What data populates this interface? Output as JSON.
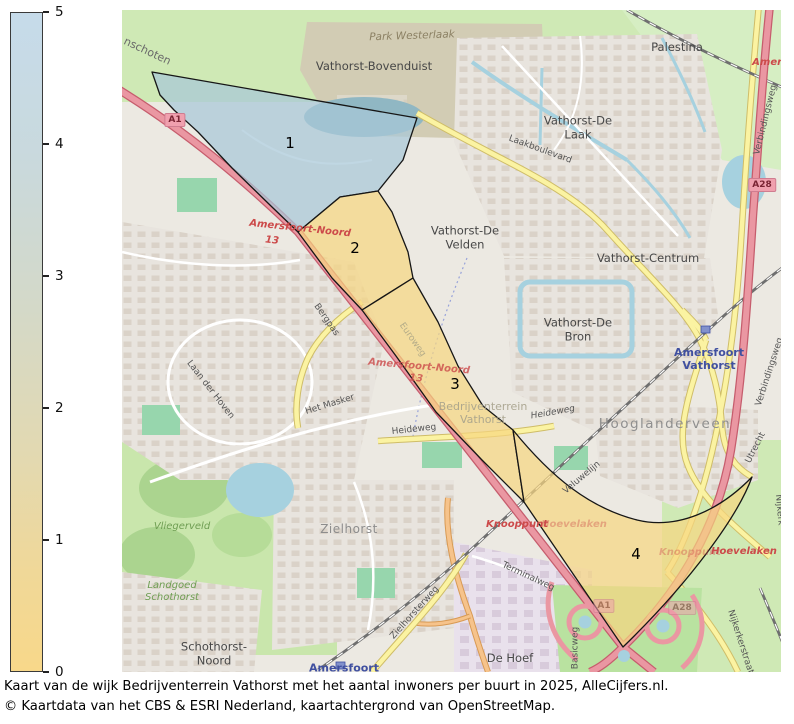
{
  "legend": {
    "max": 5,
    "min": 0,
    "ticks": [
      5,
      4,
      3,
      2,
      1,
      0
    ],
    "top_color": "#c6dbea",
    "bottom_color": "#f8d88a"
  },
  "map": {
    "regions": [
      {
        "number": "1",
        "fill": "#a8c8d8"
      },
      {
        "number": "2",
        "fill": "#f7d680"
      },
      {
        "number": "3",
        "fill": "#f7d680"
      },
      {
        "number": "4",
        "fill": "#f7d680"
      }
    ],
    "labels": [
      {
        "name": "road-label-bunschoten",
        "text": "nschoten",
        "x": 25,
        "y": 42,
        "rot": 25,
        "cls": "road road-lg"
      },
      {
        "name": "park-label-westerlaak",
        "text": "Park Westerlaak",
        "x": 290,
        "y": 26,
        "rot": -2,
        "cls": "park-label"
      },
      {
        "name": "hood-label-bovenduist",
        "text": "Vathorst-Bovenduist",
        "x": 252,
        "y": 57,
        "rot": 0,
        "cls": "hood"
      },
      {
        "name": "hood-label-palestina",
        "text": "Palestina",
        "x": 555,
        "y": 38,
        "rot": 0,
        "cls": "hood"
      },
      {
        "name": "exit-label-amersfoort-ne",
        "text": "Amersfoort",
        "x": 662,
        "y": 53,
        "rot": 0,
        "cls": "exit-red"
      },
      {
        "name": "badge-a1",
        "text": "A1",
        "x": 53,
        "y": 110,
        "rot": 0,
        "cls": "badge"
      },
      {
        "name": "hood-label-de-laak",
        "text": "Vathorst-De\nLaak",
        "x": 456,
        "y": 118,
        "rot": 0,
        "cls": "hood"
      },
      {
        "name": "road-label-laakboulevard",
        "text": "Laakboulevard",
        "x": 418,
        "y": 140,
        "rot": 20,
        "cls": "road"
      },
      {
        "name": "road-label-verbindingsweg-n",
        "text": "Verbindingsweg",
        "x": 644,
        "y": 110,
        "rot": -76,
        "cls": "road"
      },
      {
        "name": "badge-a28-n",
        "text": "A28",
        "x": 640,
        "y": 175,
        "rot": 0,
        "cls": "badge"
      },
      {
        "name": "hood-label-de-velden",
        "text": "Vathorst-De\nVelden",
        "x": 343,
        "y": 228,
        "rot": 0,
        "cls": "hood"
      },
      {
        "name": "hood-label-centrum",
        "text": "Vathorst-Centrum",
        "x": 526,
        "y": 249,
        "rot": 0,
        "cls": "hood"
      },
      {
        "name": "hood-label-de-bron",
        "text": "Vathorst-De\nBron",
        "x": 456,
        "y": 320,
        "rot": 0,
        "cls": "hood"
      },
      {
        "name": "station-label-amersfoort-vathorst",
        "text": "Amersfoort\nVathorst",
        "x": 587,
        "y": 350,
        "rot": 0,
        "cls": "station"
      },
      {
        "name": "road-label-verbindingsweg-s",
        "text": "Verbindingsweg",
        "x": 648,
        "y": 362,
        "rot": -72,
        "cls": "road"
      },
      {
        "name": "hood-label-hooglanderveen",
        "text": "Hooglanderveen",
        "x": 543,
        "y": 415,
        "rot": 0,
        "cls": "hood-lg"
      },
      {
        "name": "road-label-heideweg-w",
        "text": "Heideweg",
        "x": 292,
        "y": 420,
        "rot": -6,
        "cls": "road"
      },
      {
        "name": "road-label-heideweg-e",
        "text": "Heideweg",
        "x": 431,
        "y": 403,
        "rot": -10,
        "cls": "road road-it"
      },
      {
        "name": "road-label-het-masker",
        "text": "Het Masker",
        "x": 208,
        "y": 395,
        "rot": -17,
        "cls": "road"
      },
      {
        "name": "road-label-laan-der-hoven",
        "text": "Laan der Hoven",
        "x": 88,
        "y": 380,
        "rot": 52,
        "cls": "road"
      },
      {
        "name": "road-label-bergpas",
        "text": "Bergpas",
        "x": 204,
        "y": 310,
        "rot": 55,
        "cls": "road"
      },
      {
        "name": "road-label-euroweg",
        "text": "Euroweg",
        "x": 290,
        "y": 330,
        "rot": 55,
        "cls": "road-faint"
      },
      {
        "name": "exit-label-amersfoort-noord-1",
        "text": "Amersfoort-Noord",
        "x": 178,
        "y": 219,
        "rot": 6,
        "cls": "exit-red"
      },
      {
        "name": "exit-label-13-1",
        "text": "13",
        "x": 150,
        "y": 231,
        "rot": 6,
        "cls": "exit-red"
      },
      {
        "name": "exit-label-amersfoort-noord-2",
        "text": "Amersfoort-Noord",
        "x": 297,
        "y": 357,
        "rot": 5,
        "cls": "exit-red exit-faint2"
      },
      {
        "name": "exit-label-13-2",
        "text": "13",
        "x": 294,
        "y": 369,
        "rot": 5,
        "cls": "exit-red exit-faint2"
      },
      {
        "name": "hood-label-bedrijventerrein",
        "text": "Bedrijventerrein\nVathorst",
        "x": 361,
        "y": 404,
        "rot": 0,
        "cls": "hood-faint"
      },
      {
        "name": "region-label-1",
        "text": "1",
        "x": 168,
        "y": 134,
        "rot": 0,
        "cls": "region-num"
      },
      {
        "name": "region-label-2",
        "text": "2",
        "x": 233,
        "y": 239,
        "rot": 0,
        "cls": "region-num"
      },
      {
        "name": "region-label-3",
        "text": "3",
        "x": 333,
        "y": 375,
        "rot": 0,
        "cls": "region-num"
      },
      {
        "name": "region-label-4",
        "text": "4",
        "x": 514,
        "y": 545,
        "rot": 0,
        "cls": "region-num"
      },
      {
        "name": "exit-label-knooppunt-w",
        "text": "Knooppunt",
        "x": 395,
        "y": 515,
        "rot": 0,
        "cls": "exit-red"
      },
      {
        "name": "exit-label-hoevelaken-w",
        "text": "Hoevelaken",
        "x": 452,
        "y": 515,
        "rot": 0,
        "cls": "exit-red exit-faint"
      },
      {
        "name": "exit-label-knooppunt-e",
        "text": "Knooppunt",
        "x": 568,
        "y": 543,
        "rot": 0,
        "cls": "exit-red exit-faint"
      },
      {
        "name": "exit-label-hoevelaken-e",
        "text": "Hoevelaken",
        "x": 622,
        "y": 542,
        "rot": 0,
        "cls": "exit-red"
      },
      {
        "name": "road-label-terminalweg",
        "text": "Terminalweg",
        "x": 406,
        "y": 567,
        "rot": 25,
        "cls": "road"
      },
      {
        "name": "hood-label-de-hoef",
        "text": "De Hoef",
        "x": 388,
        "y": 649,
        "rot": 0,
        "cls": "hood"
      },
      {
        "name": "road-label-basicweg",
        "text": "Basicweg",
        "x": 454,
        "y": 638,
        "rot": -90,
        "cls": "road"
      },
      {
        "name": "hood-label-zielhorst",
        "text": "Zielhorst",
        "x": 227,
        "y": 519,
        "rot": 0,
        "cls": "hood hood-faded"
      },
      {
        "name": "green-label-vliegerveld",
        "text": "Vliegerveld",
        "x": 60,
        "y": 517,
        "rot": 0,
        "cls": "green-label"
      },
      {
        "name": "green-label-landgoed-schothorst",
        "text": "Landgoed\nSchothorst",
        "x": 50,
        "y": 582,
        "rot": 0,
        "cls": "green-label"
      },
      {
        "name": "hood-label-schothorst-noord",
        "text": "Schothorst-\nNoord",
        "x": 92,
        "y": 644,
        "rot": 0,
        "cls": "hood"
      },
      {
        "name": "road-label-zielhorsterweg",
        "text": "Zielhorsterweg",
        "x": 293,
        "y": 603,
        "rot": -48,
        "cls": "road"
      },
      {
        "name": "road-label-utrecht",
        "text": "Utrecht",
        "x": 634,
        "y": 438,
        "rot": -63,
        "cls": "road"
      },
      {
        "name": "road-label-nijkerk",
        "text": "Nijkerk",
        "x": 657,
        "y": 500,
        "rot": 85,
        "cls": "road"
      },
      {
        "name": "road-label-nijkerkerstraat",
        "text": "Nijkerkerstraat",
        "x": 618,
        "y": 632,
        "rot": 72,
        "cls": "road"
      },
      {
        "name": "rail-label-veluwelijn",
        "text": "Veluwelijn",
        "x": 460,
        "y": 468,
        "rot": -40,
        "cls": "road"
      },
      {
        "name": "badge-a1-s",
        "text": "A1",
        "x": 482,
        "y": 596,
        "rot": 0,
        "cls": "badge badge-faded"
      },
      {
        "name": "badge-a28-s",
        "text": "A28",
        "x": 560,
        "y": 598,
        "rot": 0,
        "cls": "badge badge-faded"
      },
      {
        "name": "station-label-amersfoort-s",
        "text": "Amersfoort",
        "x": 222,
        "y": 659,
        "rot": 0,
        "cls": "station"
      }
    ]
  },
  "caption": {
    "line1": "Kaart van de wijk Bedrijventerrein Vathorst met het aantal inwoners per buurt in 2025, AlleCijfers.nl.",
    "line2": "© Kaartdata van het CBS & ESRI Nederland, kaartachtergrond van OpenStreetMap."
  }
}
